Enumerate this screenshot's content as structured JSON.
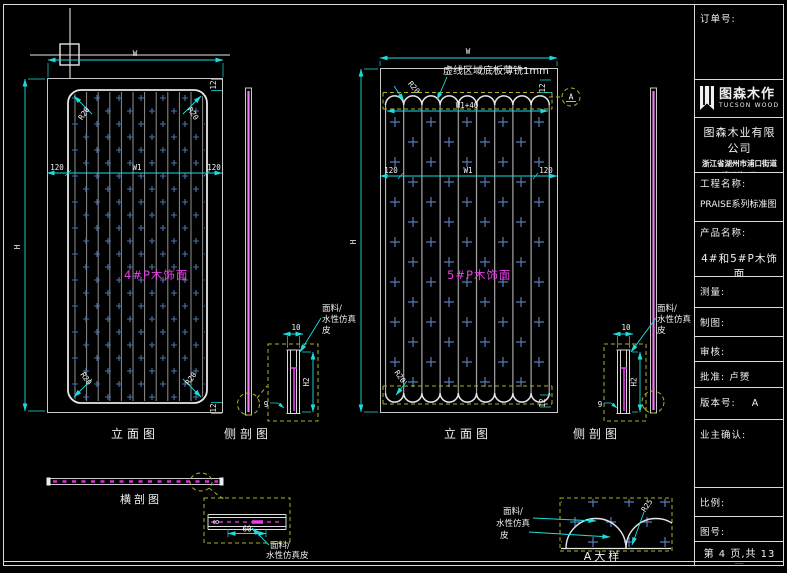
{
  "titleblock": {
    "order_label": "订单号:",
    "brand_cn": "图森木作",
    "brand_en": "TUCSON WOOD",
    "company": "图森木业有限公司",
    "address_line1": "浙江省湖州市浦口街道",
    "address_line2": "建设路1号",
    "project_label": "工程名称:",
    "project_value": "PRAISE系列标准图",
    "product_label": "产品名称:",
    "product_value": "4#和5#P木饰面",
    "measure_label": "测量:",
    "draft_label": "制图:",
    "review_label": "审核:",
    "approve_label": "批准: 卢赟",
    "version_label": "版本号:",
    "version_value": "A",
    "owner_label": "业主确认:",
    "scale_label": "比例:",
    "drawing_no_label": "图号:",
    "page_info": "第 4 页,共 13 页"
  },
  "captions": {
    "elevation": "立面图",
    "side_section": "侧剖图",
    "cross_section": "横剖图",
    "detail_a": "A大样"
  },
  "labels": {
    "panel4": "4#P木饰面",
    "panel5": "5#P木饰面",
    "dashed_note": "虚线区域底板薄铣1mm",
    "material_1": "面料/",
    "material_2": "水性仿真",
    "material_3": "皮",
    "material_23": "水性仿真皮",
    "detail_marker": "A"
  },
  "dims": {
    "w": "W",
    "w1": "W1",
    "h": "H",
    "h2": "H2",
    "d120": "120",
    "d12": "12",
    "w1_40": "W1+40",
    "r20": "R20",
    "r25": "R25",
    "d10": "10",
    "d9": "9",
    "d8": "8",
    "d60": "60"
  },
  "colors": {
    "background": "#000000",
    "line": "#e6e6e6",
    "dimension": "#1adede",
    "hatch_blue": "#4d72a8",
    "magenta": "#e93fe9",
    "strip_pink": "#f07af0",
    "dashed_yellow": "#b0b02a"
  }
}
